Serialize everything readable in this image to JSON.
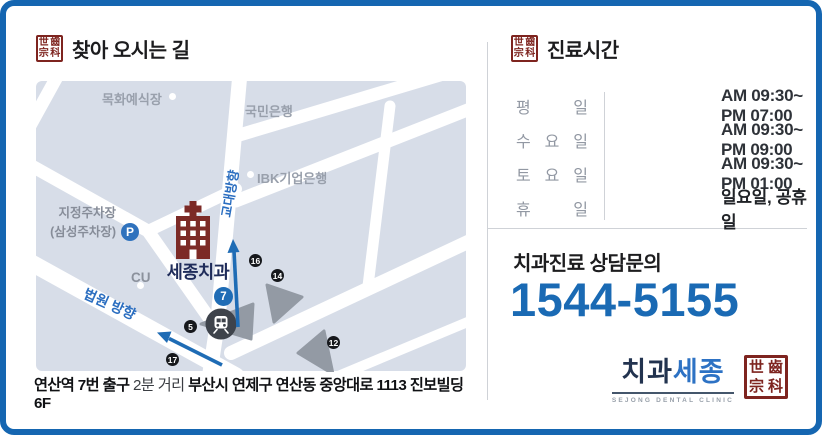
{
  "colors": {
    "border_blue": "#1566b1",
    "accent_blue": "#1f6cb5",
    "phone_blue": "#1a6ab4",
    "stamp_red": "#7e241f",
    "clinic_navy": "#1f2c5a",
    "building_red": "#7c2a26",
    "map_block": "#d7dde8"
  },
  "left": {
    "stamp": {
      "c1": "世",
      "c2": "齒",
      "c3": "宗",
      "c4": "科"
    },
    "title": "찾아 오시는 길",
    "map": {
      "landmark_mokhwa": "목화예식장",
      "landmark_kookmin": "국민은행",
      "landmark_ibk": "IBK기업은행",
      "landmark_cu": "CU",
      "parking_line1": "지정주차장",
      "parking_line2": "(삼성주차장)",
      "parking_badge": "P",
      "clinic_name": "세종치과",
      "direction_gyodae": "교대방향",
      "direction_court": "법원 방향",
      "exit_blue": "7",
      "exit_16": "16",
      "exit_14": "14",
      "exit_12": "12",
      "exit_17": "17",
      "exit_5": "5"
    },
    "address": {
      "part1": "연산역 7번 출구",
      "part2": "2분 거리",
      "part3": "부산시 연제구 연산동 중앙대로 1113 진보빌딩 6F"
    }
  },
  "right": {
    "title": "진료시간",
    "schedule": [
      {
        "day": "평 일",
        "time": "AM 09:30~ PM 07:00"
      },
      {
        "day": "수 요 일",
        "time": "AM 09:30~ PM 09:00"
      },
      {
        "day": "토 요 일",
        "time": "AM 09:30~ PM 01:00"
      },
      {
        "day": "휴 일",
        "time": "일요일, 공휴일"
      }
    ],
    "contact_label": "치과진료 상담문의",
    "phone": "1544-5155",
    "logo": {
      "name_part1": "치과",
      "name_part2": "세종",
      "tagline": "SEJONG DENTAL CLINIC"
    }
  }
}
